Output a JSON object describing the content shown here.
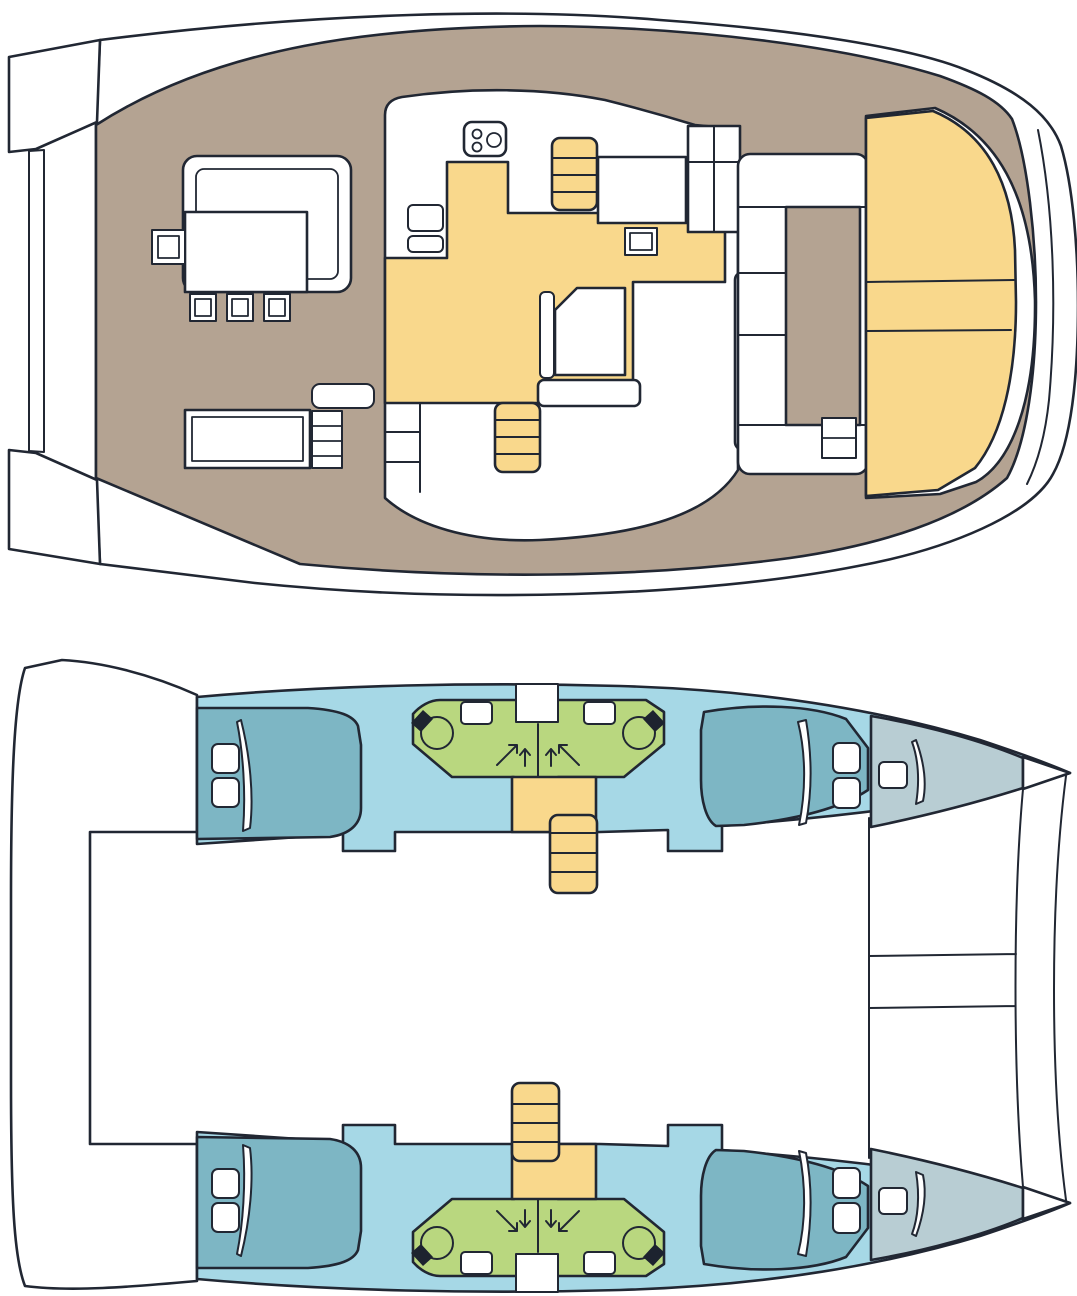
{
  "document": {
    "type": "boat-floor-plan",
    "subject": "catamaran-layout-two-deck-views",
    "views": [
      {
        "id": "main-deck-plan",
        "position": "top",
        "regions": [
          "side-deck-ring",
          "bow-tips",
          "foredeck-walkway",
          "forward-seating-area",
          "salon-galley",
          "aft-cockpit",
          "aft-sunbed-seats"
        ],
        "features": {
          "stove_burners": 2,
          "galley_sinks": 2,
          "forward_stools": 3,
          "companionway_stairs": 2,
          "aft_seat_sections": 3,
          "cockpit_table": 1,
          "dinette_table": 1,
          "forward_table": 1
        }
      },
      {
        "id": "hull-accommodation-plan",
        "position": "bottom",
        "regions": [
          "port-hull",
          "starboard-hull",
          "aft-platform",
          "bow-crossbeam"
        ],
        "features": {
          "cabins": 4,
          "double_beds": 4,
          "pillows_per_aft_bed": 2,
          "heads_compartments": 4,
          "toilets": 4,
          "sinks": 4,
          "shower_symbols": 4,
          "companionway_stairs": 2,
          "bow_lockers": 2
        }
      }
    ]
  },
  "palette": {
    "page": "#ffffff",
    "outline": "#212733",
    "white": "#ffffff",
    "deck_tan": "#b4a392",
    "salon_yellow": "#f9d88c",
    "hull_blue": "#a6d8e6",
    "bed_teal": "#7db6c4",
    "head_green": "#b9d77f",
    "bow_gray": "#b8cdd3",
    "seat_black": "#1d232f"
  }
}
